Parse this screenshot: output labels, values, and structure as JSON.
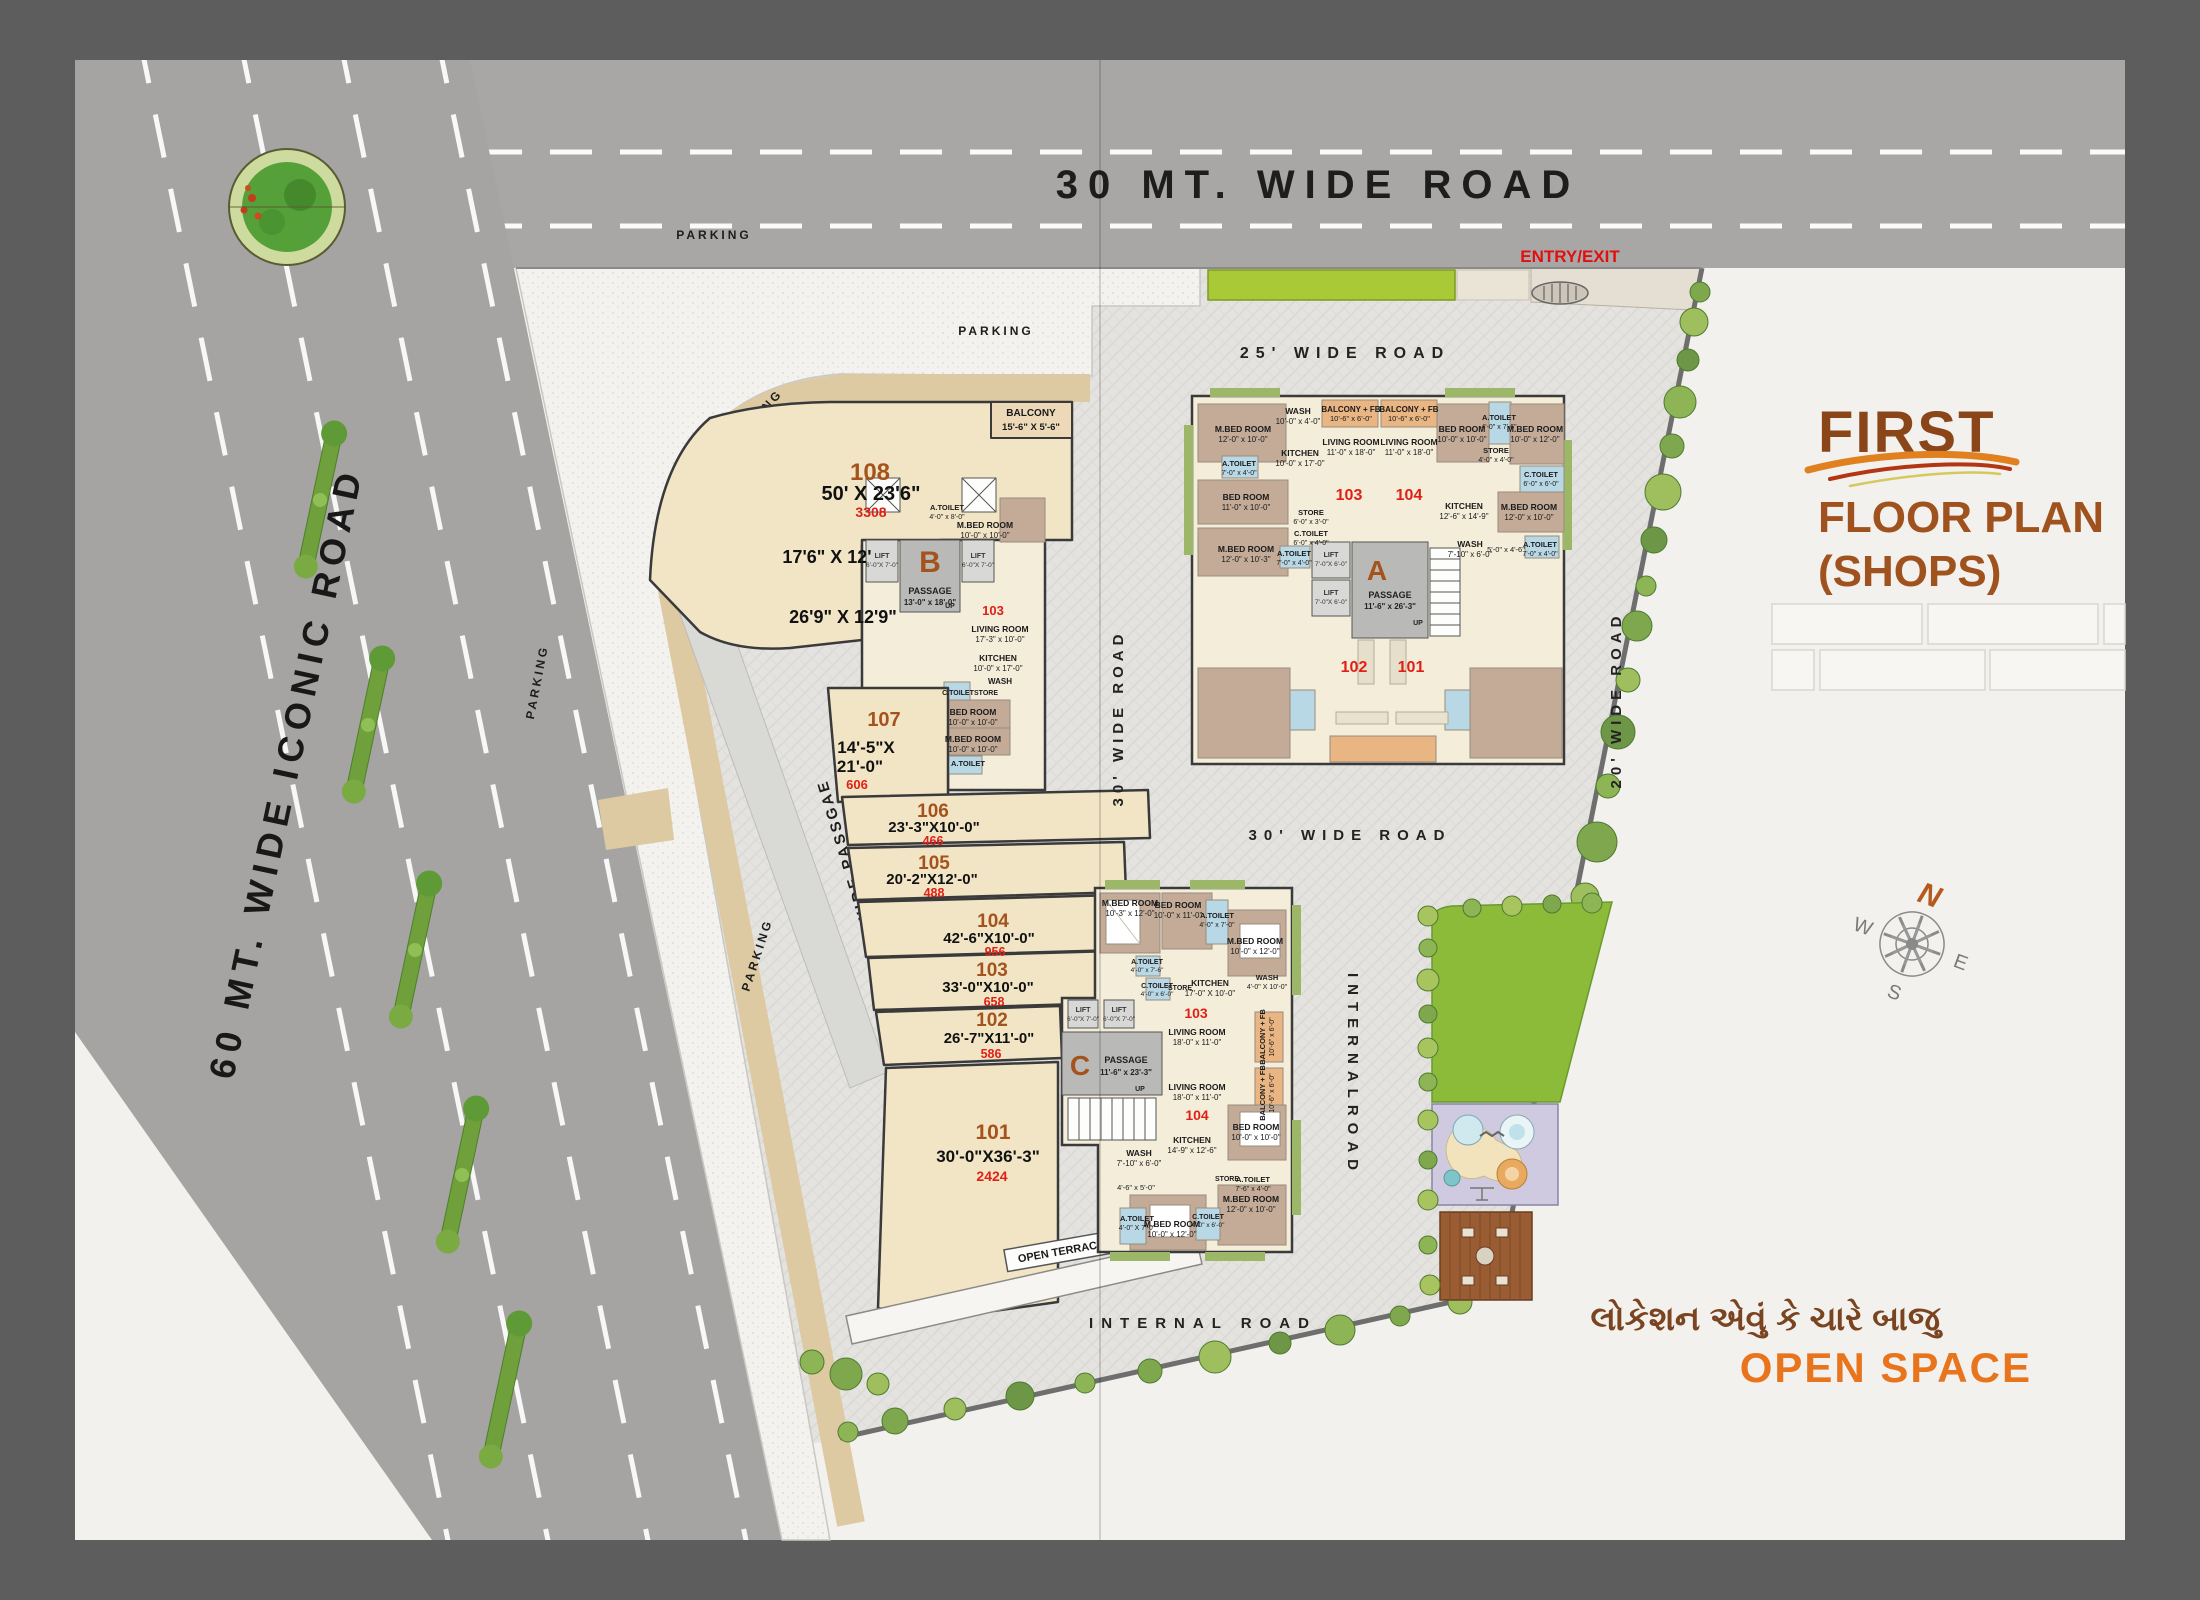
{
  "title": {
    "l1": "FIRST",
    "l2": "FLOOR PLAN",
    "l3": "(SHOPS)"
  },
  "tagline": {
    "gu": "લોકેશન એવું કે ચારે બાજુ",
    "en": "OPEN SPACE"
  },
  "roads": {
    "top": "30 MT.   WIDE ROAD",
    "left": "60 MT. WIDE ICONIC ROAD",
    "r25": "25' WIDE ROAD",
    "r30v": "30' WIDE ROAD",
    "r30h": "30' WIDE ROAD",
    "r20": "20' WIDE ROAD",
    "internal_v": "INTERNALROAD",
    "internal_h": "INTERNAL ROAD",
    "passage10": "10'-0\" WIDE PASSGAE"
  },
  "misc": {
    "entry": "ENTRY/EXIT",
    "open_terrace": "OPEN TERRACE"
  },
  "parking": [
    "PARKING",
    "PARKING",
    "PARKING",
    "PARKING",
    "PARKING"
  ],
  "compass": {
    "n": "N",
    "e": "E",
    "s": "S",
    "w": "W"
  },
  "balcony": {
    "label": "BALCONY",
    "dim": "15'-6\" X 5'-6\""
  },
  "shop_extra": {
    "dim_a": "17'6\" X 12'",
    "dim_b": "26'9\" X 12'9\""
  },
  "shops": [
    {
      "num": "101",
      "dim": "30'-0\"X36'-3\"",
      "area": "2424"
    },
    {
      "num": "102",
      "dim": "26'-7\"X11'-0\"",
      "area": "586"
    },
    {
      "num": "103",
      "dim": "33'-0\"X10'-0\"",
      "area": "658"
    },
    {
      "num": "104",
      "dim": "42'-6\"X10'-0\"",
      "area": "956"
    },
    {
      "num": "105",
      "dim": "20'-2\"X12'-0\"",
      "area": "488"
    },
    {
      "num": "106",
      "dim": "23'-3\"X10'-0\"",
      "area": "466"
    },
    {
      "num": "107",
      "dim": "14'-5\"X",
      "dim2": "21'-0\"",
      "area": "606"
    },
    {
      "num": "108",
      "dim": "50' X 23'6\"",
      "area": "3308"
    }
  ],
  "blocks": {
    "a": {
      "letter": "A",
      "passage": "PASSAGE",
      "passage_dim": "11'-6\" x 26'-3\"",
      "up": "UP",
      "u101": "101",
      "u102": "102",
      "u103": "103",
      "u104": "104"
    },
    "b": {
      "letter": "B",
      "passage": "PASSAGE",
      "passage_dim": "13'-0\" x 18'-0\"",
      "up": "UP",
      "unit": "103"
    },
    "c": {
      "letter": "C",
      "passage": "PASSAGE",
      "passage_dim": "11'-6\" x 23'-3\"",
      "up": "UP",
      "u103": "103",
      "u104": "104"
    }
  },
  "lift": {
    "label": "LIFT",
    "dim_b": "6'-0\"X 7'-0\"",
    "dim_a": "7'-0\"X 6'-0\""
  },
  "rooms_a": [
    {
      "n": "M.BED ROOM",
      "d": "12'-0\" x 10'-0\""
    },
    {
      "n": "WASH",
      "d": "10'-0\" x 4'-0\""
    },
    {
      "n": "BALCONY + FB",
      "d": "10'-6\" x 6'-0\""
    },
    {
      "n": "BALCONY + FB",
      "d": "10'-6\" x 6'-0\""
    },
    {
      "n": "BED ROOM",
      "d": "10'-0\" x 10'-0\""
    },
    {
      "n": "A.TOILET",
      "d": "4'-0\" x 7'-6\""
    },
    {
      "n": "M.BED ROOM",
      "d": "10'-0\" x 12'-0\""
    },
    {
      "n": "KITCHEN",
      "d": "10'-0\" x 17'-0\""
    },
    {
      "n": "LIVING ROOM",
      "d": "11'-0\" x 18'-0\""
    },
    {
      "n": "LIVING ROOM",
      "d": "11'-0\" x 18'-0\""
    },
    {
      "n": "STORE",
      "d": "4'-0\" x 4'-0\""
    },
    {
      "n": "C.TOILET",
      "d": "6'-0\" x 6'-0\""
    },
    {
      "n": "A.TOILET",
      "d": "7'-0\" x 4'-0\""
    },
    {
      "n": "BED ROOM",
      "d": "11'-0\" x 10'-0\""
    },
    {
      "n": "KITCHEN",
      "d": "12'-6\" x 14'-9\""
    },
    {
      "n": "M.BED ROOM",
      "d": "12'-0\" x 10'-0\""
    },
    {
      "n": "STORE",
      "d": "6'-0\" x 3'-0\""
    },
    {
      "n": "C.TOILET",
      "d": "6'-0\" x 4'-0\""
    },
    {
      "n": "M.BED ROOM",
      "d": "12'-0\" x 10'-3\""
    },
    {
      "n": "A.TOILET",
      "d": "7'-0\" x 4'-0\""
    },
    {
      "n": "WASH",
      "d": "7'-10\" x 6'-0\""
    },
    {
      "n": "",
      "d": "5'-0\" x 4'-6\""
    },
    {
      "n": "A.TOILET",
      "d": "7'-0\" x 4'-0\""
    }
  ],
  "rooms_b": [
    {
      "n": "M.BED ROOM",
      "d": "10'-0\" x 10'-0\""
    },
    {
      "n": "A.TOILET",
      "d": "4'-0\" x 8'-0\""
    },
    {
      "n": "LIVING ROOM",
      "d": "17'-3\" x 10'-0\""
    },
    {
      "n": "KITCHEN",
      "d": "10'-0\" x 17'-0\""
    },
    {
      "n": "WASH",
      "d": ""
    },
    {
      "n": "C.TOILET",
      "d": "6'-0\" x 4'-0\""
    },
    {
      "n": "STORE",
      "d": "4'-0\" x 4'-0\""
    },
    {
      "n": "BED ROOM",
      "d": "10'-0\" x 10'-0\""
    },
    {
      "n": "M.BED ROOM",
      "d": "10'-0\" x 10'-0\""
    },
    {
      "n": "A.TOILET",
      "d": "7'-0\" x 4'-0\""
    }
  ],
  "rooms_c": [
    {
      "n": "M.BED ROOM",
      "d": "10'-3\" x 12'-0\""
    },
    {
      "n": "BED ROOM",
      "d": "10'-0\" x 11'-0\""
    },
    {
      "n": "A.TOILET",
      "d": "4'-0\" x 7'-0\""
    },
    {
      "n": "M.BED ROOM",
      "d": "10'-0\" x 12'-0\""
    },
    {
      "n": "WASH",
      "d": "4'-0\" X 10'-0\""
    },
    {
      "n": "KITCHEN",
      "d": "17'-0\" X 10'-0\""
    },
    {
      "n": "A.TOILET",
      "d": "4'-0\" x 7'-6\""
    },
    {
      "n": "C.TOILET",
      "d": "4'-0\" x 6'-0\""
    },
    {
      "n": "STORE",
      "d": "2'-0\" x 6'-0\""
    },
    {
      "n": "LIVING ROOM",
      "d": "18'-0\" x 11'-0\""
    },
    {
      "n": "BALCONY + FB",
      "d": "10'-6\" x 6'-0\""
    },
    {
      "n": "LIVING ROOM",
      "d": "18'-0\" x 11'-0\""
    },
    {
      "n": "BALCONY + FB",
      "d": "10'-6\" x 6'-0\""
    },
    {
      "n": "KITCHEN",
      "d": "14'-9\" x 12'-6\""
    },
    {
      "n": "WASH",
      "d": "7'-10\" x 6'-0\""
    },
    {
      "n": "BED ROOM",
      "d": "10'-0\" x 10'-0\""
    },
    {
      "n": "STORE",
      "d": ""
    },
    {
      "n": "A.TOILET",
      "d": "7'-6\" x 4'-0\""
    },
    {
      "n": "M.BED ROOM",
      "d": "12'-0\" x 10'-0\""
    },
    {
      "n": "",
      "d": "4'-6\" x 5'-0\""
    },
    {
      "n": "A.TOILET",
      "d": "4'-0\" X 7'-0\""
    },
    {
      "n": "M.BED ROOM",
      "d": "10'-0\" x 12'-0\""
    },
    {
      "n": "C.TOILET",
      "d": "4'-0\" x 6'-0\""
    }
  ],
  "colors": {
    "accent_brown": "#a5531c",
    "unit_red": "#e02015",
    "open_space_orange": "#e8741e",
    "lawn_green": "#8cbb39",
    "road_gray": "#a8a7a5"
  }
}
